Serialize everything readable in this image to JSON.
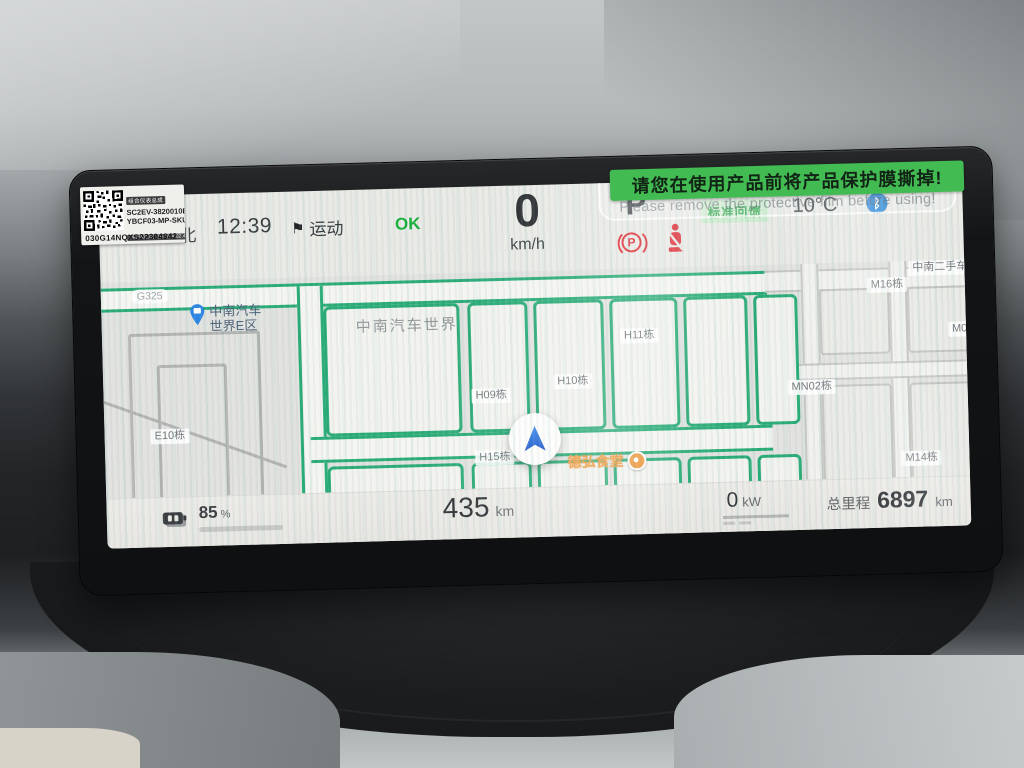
{
  "colors": {
    "accent_green": "#18b13c",
    "banner_green": "#42bb52",
    "road_green": "#2aac77",
    "warning_red": "#e0313a",
    "bluetooth_blue": "#1b7fd6",
    "battery_green": "#2fc04a",
    "regen_badge_bg": "#cdeccf",
    "regen_badge_text": "#2da44a",
    "poi_orange": "#ef9a3e",
    "poi_blue": "#2e86e2"
  },
  "protective_film": {
    "banner_zh": "请您在使用产品前将产品保护膜撕掉!",
    "banner_en": "Please remove the protective film before using!"
  },
  "part_sticker": {
    "name": "组合仪表总成",
    "code1": "SC2EV-3820010B",
    "code2": "YBCF03-MP-SKU1",
    "version": "HW:V02.00 SW:V04.02.40",
    "serial": "030G14NQXS22304642"
  },
  "status_bar": {
    "compass": "北",
    "time": "12:39",
    "drive_mode": "运动",
    "flag_icon": "⚑",
    "status_ok": "OK",
    "speed": "0",
    "speed_unit": "km/h",
    "gear": "P",
    "brake_warning_letter": "P",
    "regen_label": "标准回馈",
    "temperature": "10°C",
    "bluetooth_glyph": "ᛒ"
  },
  "map": {
    "vehicle_poi": {
      "line1": "中南汽车",
      "line2": "世界E区"
    },
    "area_label": "中南汽车世界",
    "canteen_poi": "德弘食堂",
    "road_badge": "G325",
    "labels": [
      {
        "text": "E10栋",
        "x": 46,
        "y": 148
      },
      {
        "text": "H09栋",
        "x": 368,
        "y": 116
      },
      {
        "text": "H10栋",
        "x": 450,
        "y": 104
      },
      {
        "text": "H11栋",
        "x": 518,
        "y": 60
      },
      {
        "text": "H15栋",
        "x": 370,
        "y": 178
      },
      {
        "text": "M16栋",
        "x": 766,
        "y": 16
      },
      {
        "text": "中南二手车市场",
        "x": 808,
        "y": 0
      },
      {
        "text": "M05栋",
        "x": 846,
        "y": 62
      },
      {
        "text": "MN02栋",
        "x": 684,
        "y": 116
      },
      {
        "text": "M14栋",
        "x": 796,
        "y": 190
      }
    ]
  },
  "bottom_bar": {
    "battery_percent": "85",
    "battery_percent_unit": "%",
    "battery_level": 0.85,
    "range": "435",
    "range_unit": "km",
    "power": "0",
    "power_unit": "kW",
    "odometer_label": "总里程",
    "odometer": "6897",
    "odometer_unit": "km"
  }
}
